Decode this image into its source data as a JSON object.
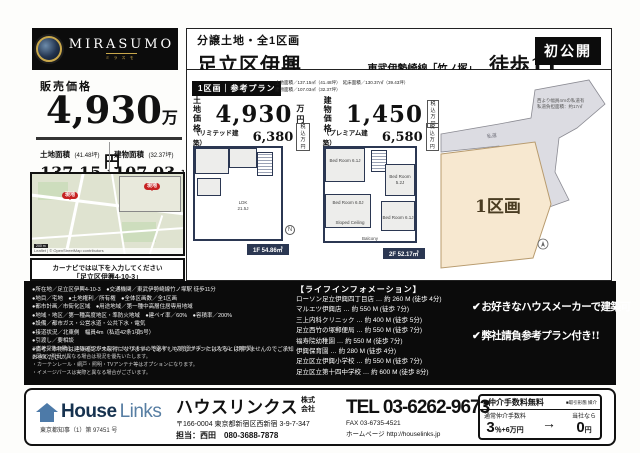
{
  "header": {
    "logo_name": "MIRASUMO",
    "logo_sub": "ミラスモ",
    "category": "分譲土地・全1区画",
    "title": "足立区伊興410①",
    "railway": "東武伊勢崎線「竹ノ塚」駅",
    "walk": "徒歩11分!!!",
    "badge": "初公開"
  },
  "price_panel": {
    "label": "販売価格",
    "price": "4,930",
    "unit": "万円",
    "land_label": "土地面積",
    "land_tsubo": "(41.48坪)",
    "land_value": "137.15",
    "land_unit": "㎡",
    "land_sub_label": "延床面積",
    "land_sub_value": "130.37㎡",
    "bldg_label": "建物面積",
    "bldg_tsubo": "(32.37坪)",
    "bldg_value": "107.03",
    "bldg_unit": "㎡",
    "bldg_sub": "（予定）"
  },
  "map": {
    "marker_label": "現地",
    "scale": "200 m",
    "attribution": "Leaflet | © OpenStreetMap contributors",
    "navi_line1": "カーナビでは以下を入力してください",
    "navi_line2": "「足立区伊興4-10-3」"
  },
  "plan": {
    "tag": "1区画｜参考プラン",
    "areas_line1": "土地面積／137.15㎡（41.48坪）　延床面積／130.37㎡（39.43坪）",
    "areas_line2": "建物面積／107.03㎡（32.37坪）",
    "land_price_label": "土地価格",
    "land_price": "4,930",
    "land_price_unit": "万円",
    "bldg_price_label": "建物価格",
    "bldg_price": "1,450",
    "bldg_price_unit1": "税込",
    "bldg_price_unit2": "万円",
    "limited_label": "（リミテッド建築）",
    "limited_price": "6,380",
    "premium_label": "（プレミアム建築）",
    "premium_price": "6,580",
    "unit_tax": "税込",
    "unit_man": "万円",
    "floor1_ldk": "LDK",
    "floor1_ldk_size": "21.5J",
    "floor1_badge": "1F 54.86㎡",
    "floor2_room1": "Bed Room 6.1J",
    "floor2_room2": "Bed Room 5.2J",
    "floor2_room3": "Bed Room 6.0J",
    "floor2_room4": "Bed Room 6.1J",
    "floor2_sloped": "Sloped Ceiling",
    "floor2_balcony": "Balcony",
    "floor2_badge": "2F 52.17㎡",
    "north": "N"
  },
  "plot": {
    "label": "1区画",
    "road_label": "私道",
    "note1": "西より幅員4ｍの私道有",
    "note2": "私道負担面積：約17㎡"
  },
  "details": {
    "bullets": [
      "●所在地／足立区伊興4-10-3　●交通機関／東武伊勢崎線竹ノ塚駅 徒歩11分",
      "●地目／宅地　●土地権利／所有権　●全体区画数／全1区画",
      "●都市計画／市街化区域　●用途地域／第一種中高層住居専用地域",
      "●地域・地区／第一種高度地区・準防火地域　●建ペイ率／60%　●容積率／200%",
      "●設備／都市ガス・公営水道・公共下水・電気",
      "●接道状況／北東側　幅員4m（私道42条1項5号）",
      "●引渡し／要相談",
      "●備考／本物件は建築確認が未取得になりますので必ずしも同じプランにはなるとは限りませんのでご承知おきください。"
    ],
    "notes": [
      "※当社提携の場合、ジャパンホームシールドまたは、地盤ネットの地盤サポートシステム（20年間）",
      "※図面と現況が異なる場合は現況を優先いたします。",
      "・カーテンレール・網戸・照明・TVアンテナ等はオプションになります。",
      "・イメージパースは実際と異なる場合がございます。"
    ]
  },
  "life_info": {
    "title": "【ライフインフォメーション】",
    "items": [
      "ローソン足立伊興四丁目店 … 約 260 M (徒歩 4分)",
      "マルエツ伊興店 … 約 550 M (徒歩 7分)",
      "三上内科クリニック … 約 400 M (徒歩 5分)",
      "足立西竹の塚郵便局 … 約 550 M (徒歩 7分)",
      "福寿院幼稚園 … 約 550 M (徒歩 7分)",
      "伊興保育園 … 約 280 M (徒歩 4分)",
      "足立区立伊興小学校 … 約 550 M (徒歩 7分)",
      "足立区立第十四中学校 … 約 600 M (徒歩 8分)"
    ],
    "check_icon": "✔",
    "check1": "お好きなハウスメーカーで建築可",
    "check2": "弊社請負参考プラン付き!!"
  },
  "footer": {
    "logo_house": "House",
    "logo_links": "Links",
    "license": "東京都知事（1）第 97451 号",
    "company": "ハウスリンクス",
    "company_suffix1": "株式",
    "company_suffix2": "会社",
    "address": "〒166-0004 東京都新宿区西新宿 3-9-7-347",
    "contact": "担当：西田　080-3688-7878",
    "tel": "TEL 03-6262-9673",
    "fax": "FAX 03-6735-4521",
    "homepage_label": "ホームページ",
    "homepage": "http://houselinks.jp",
    "fee_free": "■仲介手数料無料",
    "fee_type": "■取引形態 媒介",
    "fee_normal_label": "通常仲介手数料",
    "fee_normal_big": "3",
    "fee_normal_small": "％+6万円",
    "fee_arrow": "→",
    "fee_ours_label": "当社なら",
    "fee_ours_big": "0",
    "fee_ours_small": "円"
  },
  "colors": {
    "accent_black": "#0c0c0c",
    "plan_navy": "#2b3752",
    "marker_red": "#c62222",
    "logo_gold": "#c9a84c",
    "houselinks_blue": "#4d7aa8",
    "plot_beige": "#f7e8d0"
  }
}
